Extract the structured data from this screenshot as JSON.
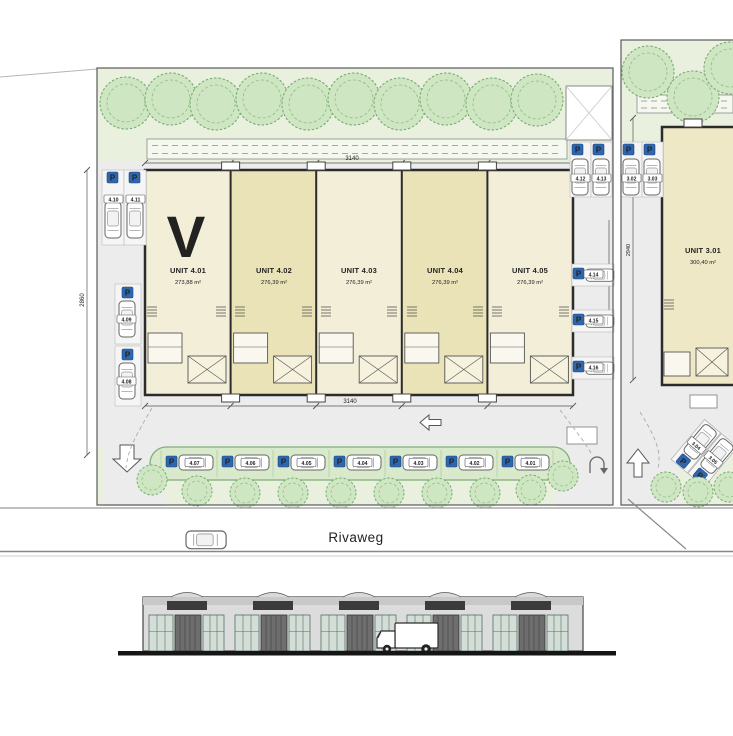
{
  "plan": {
    "revision_marker": "V",
    "street": {
      "name": "Rivaweg"
    },
    "dims": {
      "top_width": "3140",
      "bottom_width": "3140",
      "left_depth": "2860",
      "right_depth": "2455",
      "parcel2_depth": "2940"
    },
    "units": [
      {
        "name": "UNIT 4.01",
        "area": "273,88 m²"
      },
      {
        "name": "UNIT 4.02",
        "area": "276,39 m²"
      },
      {
        "name": "UNIT 4.03",
        "area": "276,39 m²"
      },
      {
        "name": "UNIT 4.04",
        "area": "276,39 m²"
      },
      {
        "name": "UNIT 4.05",
        "area": "276,39 m²"
      }
    ],
    "unit3": {
      "name": "UNIT 3.01",
      "area": "300,40 m²"
    },
    "parking": {
      "sign_letter": "P",
      "street_row": [
        "4.07",
        "4.06",
        "4.05",
        "4.04",
        "4.03",
        "4.02",
        "4.01"
      ],
      "left_top": [
        "4.10",
        "4.11"
      ],
      "left_side": [
        "4.09",
        "4.08"
      ],
      "right_top": [
        "4.12",
        "4.13"
      ],
      "right_side": [
        "4.14",
        "4.15",
        "4.16"
      ],
      "parcel2_top": [
        "3.02",
        "3.03"
      ],
      "parcel2_diagonal": [
        "3.04",
        "3.05"
      ]
    }
  },
  "colors": {
    "site_green": "#e9f1de",
    "hardscape": "#ececec",
    "tree_fill": "#cfe6c2",
    "tree_stroke": "#79ac73",
    "building_fill_a": "#f2eed8",
    "building_fill_b": "#ebe3b8",
    "building_outline": "#2b2b2b",
    "parking_strip": "#d8e9cc",
    "parking_sign_blue": "#2f66ad",
    "facade_gray": "#dcdcdc",
    "ground_black": "#151515"
  }
}
